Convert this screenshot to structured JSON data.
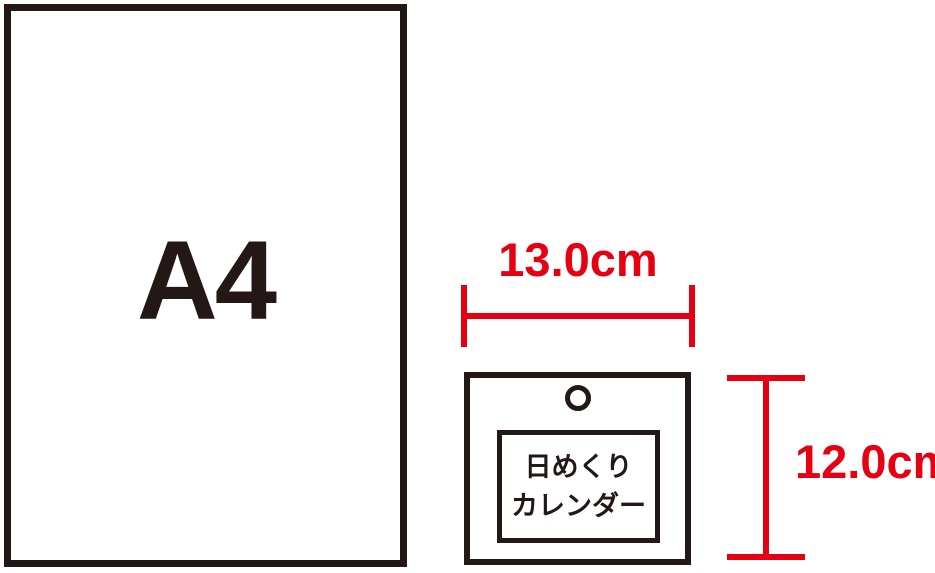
{
  "colors": {
    "ink": "#231815",
    "accent_red": "#e60012",
    "background": "#ffffff"
  },
  "a4_sheet": {
    "label": "A4"
  },
  "calendar": {
    "line1": "日めくり",
    "line2": "カレンダー"
  },
  "dimensions": {
    "width_label": "13.0cm",
    "height_label": "12.0cm"
  }
}
